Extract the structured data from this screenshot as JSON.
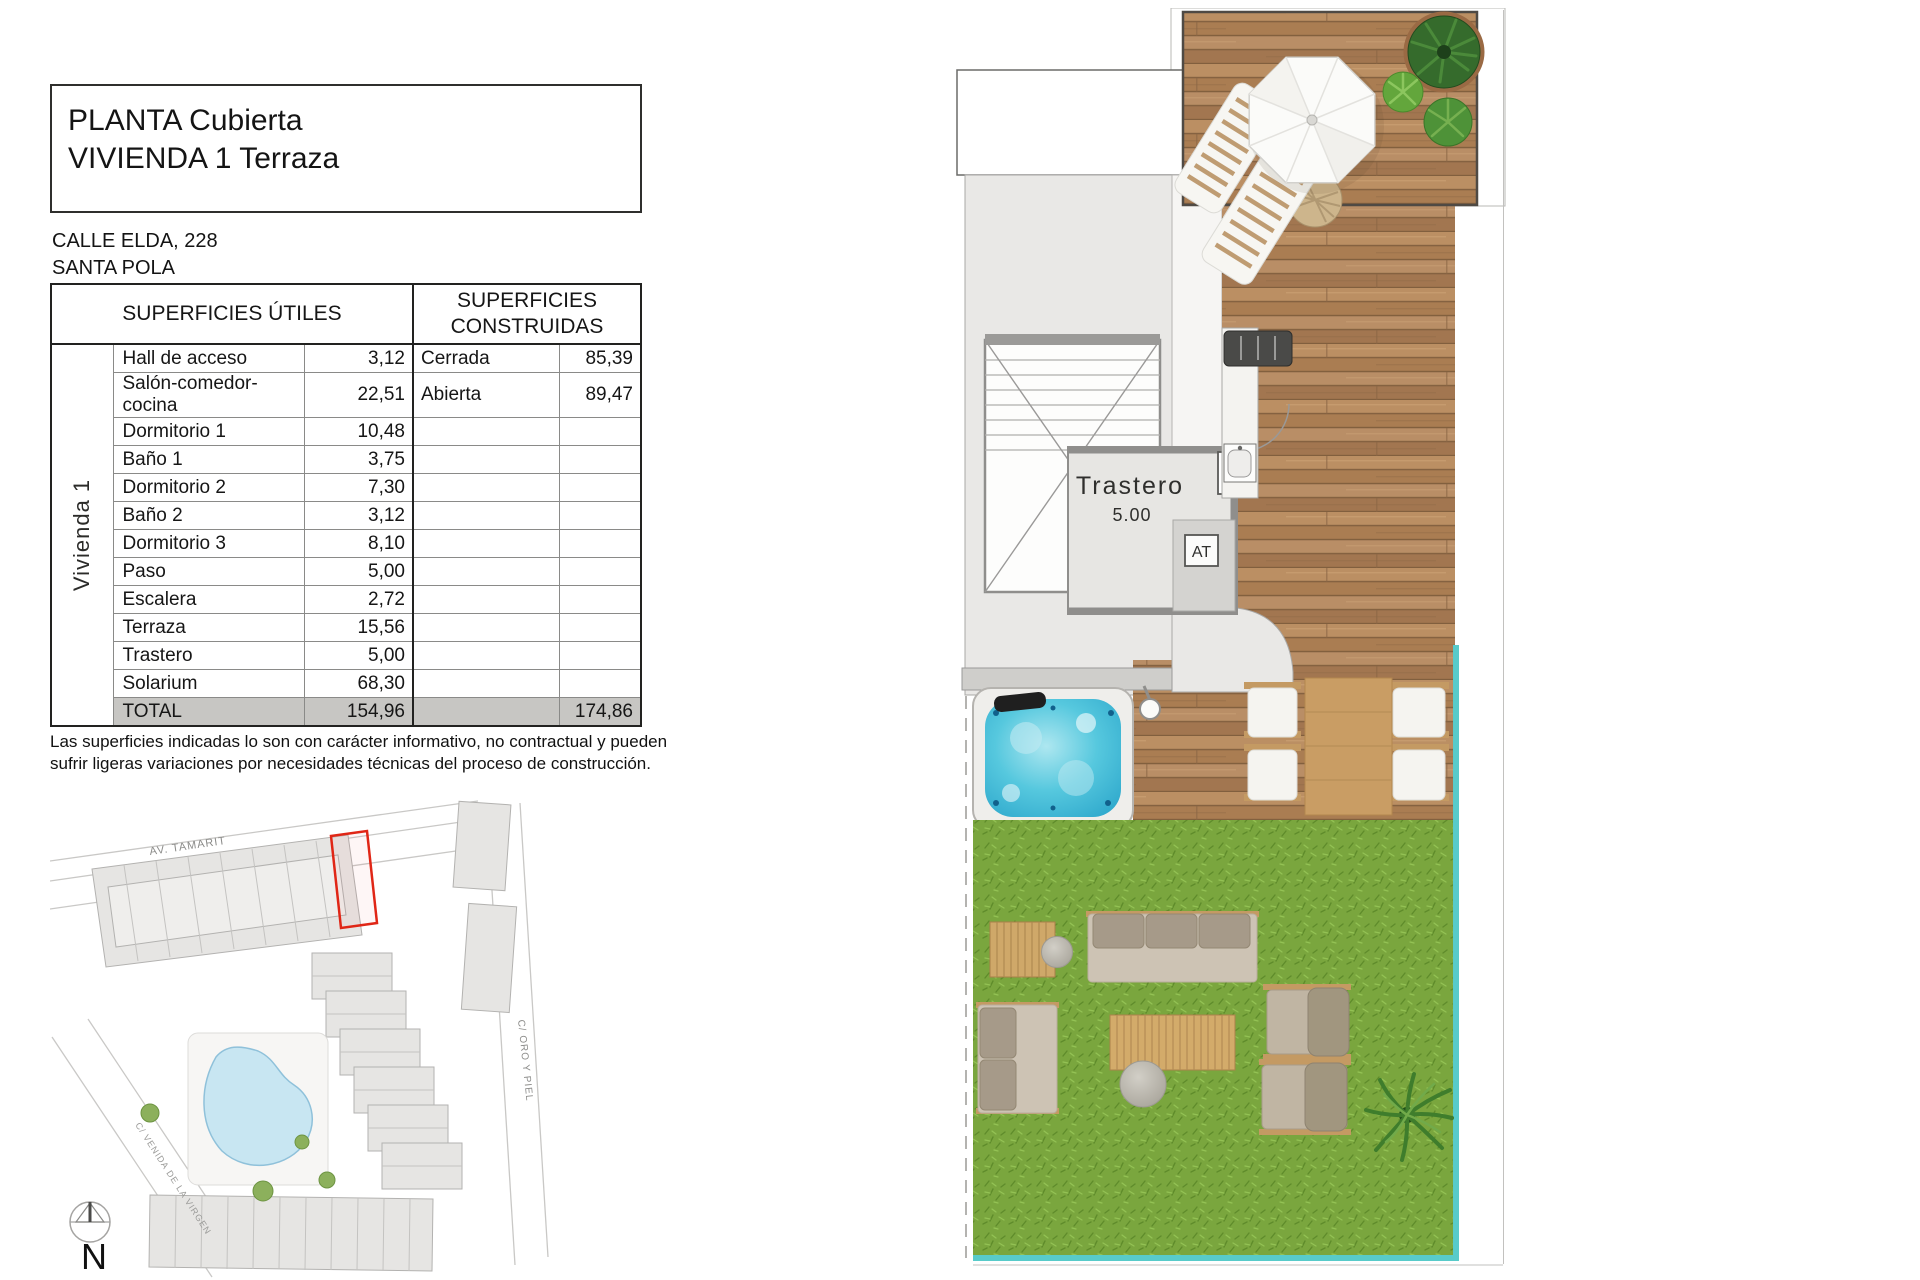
{
  "title_block": {
    "line1": "PLANTA Cubierta",
    "line2": "VIVIENDA 1 Terraza"
  },
  "address": {
    "line1": "CALLE ELDA, 228",
    "line2": "SANTA POLA"
  },
  "surfaces_table": {
    "header_utiles": "SUPERFICIES ÚTILES",
    "header_construidas": "SUPERFICIES CONSTRUIDAS",
    "group_label": "Vivienda 1",
    "rows": [
      {
        "name": "Hall de acceso",
        "value": "3,12",
        "c_label": "Cerrada",
        "c_value": "85,39"
      },
      {
        "name": "Salón-comedor-cocina",
        "value": "22,51",
        "c_label": "Abierta",
        "c_value": "89,47"
      },
      {
        "name": "Dormitorio 1",
        "value": "10,48",
        "c_label": "",
        "c_value": ""
      },
      {
        "name": "Baño 1",
        "value": "3,75",
        "c_label": "",
        "c_value": ""
      },
      {
        "name": "Dormitorio 2",
        "value": "7,30",
        "c_label": "",
        "c_value": ""
      },
      {
        "name": "Baño 2",
        "value": "3,12",
        "c_label": "",
        "c_value": ""
      },
      {
        "name": "Dormitorio 3",
        "value": "8,10",
        "c_label": "",
        "c_value": ""
      },
      {
        "name": "Paso",
        "value": "5,00",
        "c_label": "",
        "c_value": ""
      },
      {
        "name": "Escalera",
        "value": "2,72",
        "c_label": "",
        "c_value": ""
      },
      {
        "name": "Terraza",
        "value": "15,56",
        "c_label": "",
        "c_value": ""
      },
      {
        "name": "Trastero",
        "value": "5,00",
        "c_label": "",
        "c_value": ""
      },
      {
        "name": "Solarium",
        "value": "68,30",
        "c_label": "",
        "c_value": ""
      }
    ],
    "total": {
      "label": "TOTAL",
      "value": "154,96",
      "c_value": "174,86"
    }
  },
  "disclaimer": "Las superficies indicadas lo son con carácter informativo, no contractual y pueden sufrir ligeras variaciones por necesidades técnicas del proceso de construcción.",
  "floor_plan": {
    "room_label": "Trastero",
    "room_area": "5.00",
    "at_label": "AT"
  },
  "site_plan": {
    "street_av_tamarit": "AV. TAMARIT",
    "street_oro_y_piel": "C/ ORO Y PIEL",
    "street_virgen": "C/ VENIDA DE LA VIRGEN",
    "north_label": "N"
  },
  "colors": {
    "teal_border": "#58cbca",
    "red_highlight": "#e02616",
    "water": "#4fc3dc",
    "grass": "#7aa63e",
    "deck_wood": "#b2865c"
  }
}
